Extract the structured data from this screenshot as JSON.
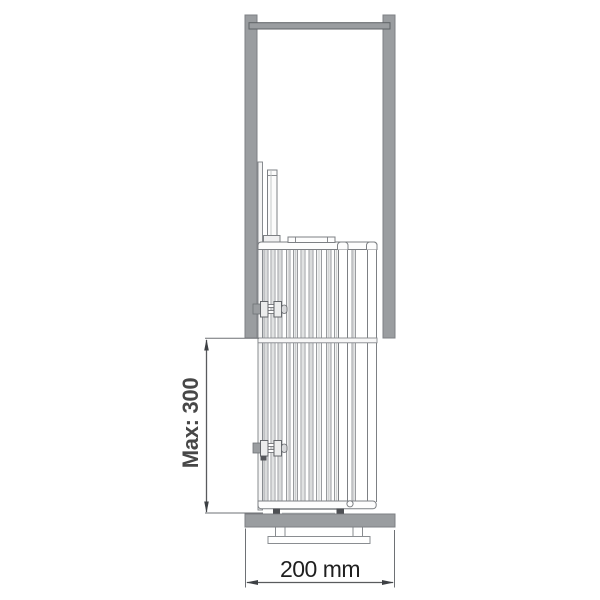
{
  "title": "Pull-out unit installation side-view drawing",
  "dimensions": {
    "height_label": "Max: 300",
    "width_label": "200 mm"
  },
  "colors": {
    "cabinet_gray": "#9a9da0",
    "cabinet_border": "#7d8084",
    "rail_border": "#5f6266",
    "drawing_outline": "#7d8084",
    "dimension_line": "#595b5e",
    "height_text": "#474747",
    "width_text": "#1f1f1f",
    "background": "#ffffff"
  }
}
